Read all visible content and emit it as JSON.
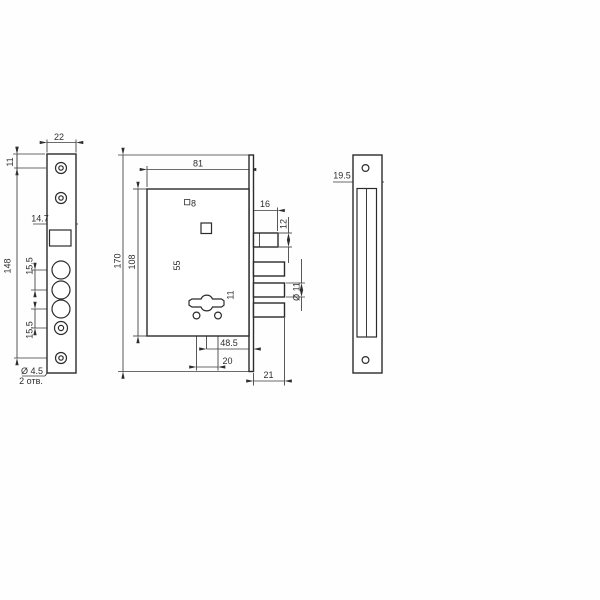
{
  "drawing": {
    "faceplate_front": {
      "width": "22",
      "top_hole_offset": "11",
      "mounting_height": "148",
      "square_cutout": "14.7",
      "hole_spacing_top": "15.5",
      "hole_spacing_bottom": "15.5",
      "hole_diameter_note": "Ø 4.5",
      "hole_count_note": "2 отв."
    },
    "lock_body": {
      "body_width": "81",
      "overall_height": "170",
      "body_height": "108",
      "spindle_square": "8",
      "spindle_to_key": "55",
      "key_to_fixing_holes": "11",
      "backset": "48.5",
      "fixing_hole_spacing": "20",
      "bolt_throw": "21",
      "latch_width": "16",
      "latch_height": "12",
      "bolt_diameter": "Ø 11"
    },
    "strike_plate": {
      "width": "19.5"
    }
  }
}
